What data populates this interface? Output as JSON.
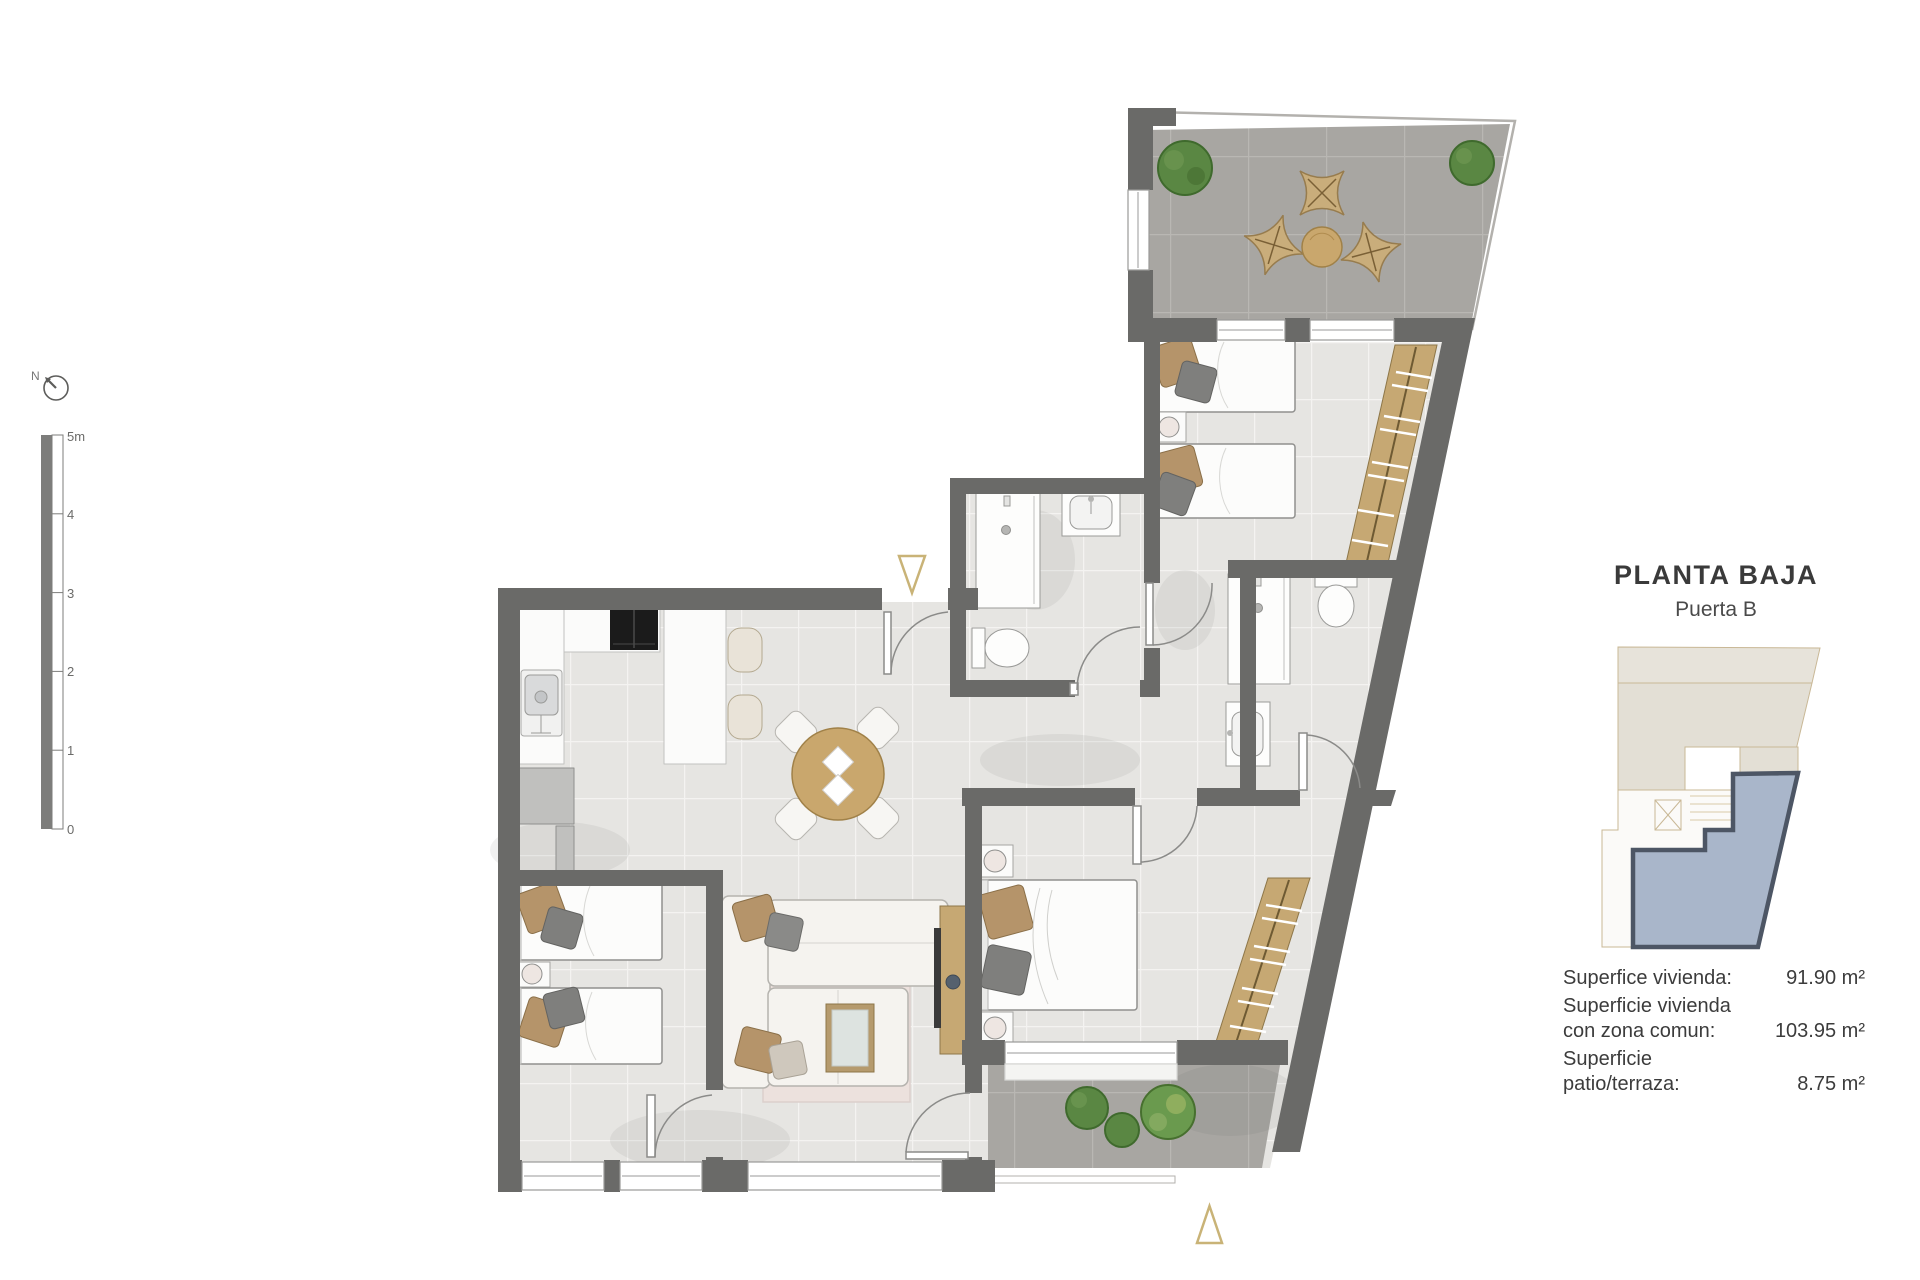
{
  "header": {
    "title": "PLANTA BAJA",
    "subtitle": "Puerta B"
  },
  "compass": {
    "label": "N"
  },
  "scale_bar": {
    "labels": [
      "5m",
      "4",
      "3",
      "2",
      "1",
      "0"
    ]
  },
  "areas": [
    {
      "label": "Superfice vivienda:",
      "value": "91.90 m²"
    },
    {
      "label": "Superficie vivienda con zona comun:",
      "value": "103.95 m²"
    },
    {
      "label": "Superficie patio/terraza:",
      "value": "8.75 m²"
    }
  ],
  "colors": {
    "wall": "#6a6a68",
    "floor_tile": "#e6e5e2",
    "terrace_tile": "#a8a6a2",
    "wood": "#c9a76d",
    "wardrobe": "#c6a873",
    "plant": "#5a8743",
    "marker": "#c9b377",
    "keyplan_unit": "#a9b6ca",
    "keyplan_outline": "#4d5665",
    "keyplan_context": "#e7e3da",
    "text": "#3c3c3c"
  }
}
